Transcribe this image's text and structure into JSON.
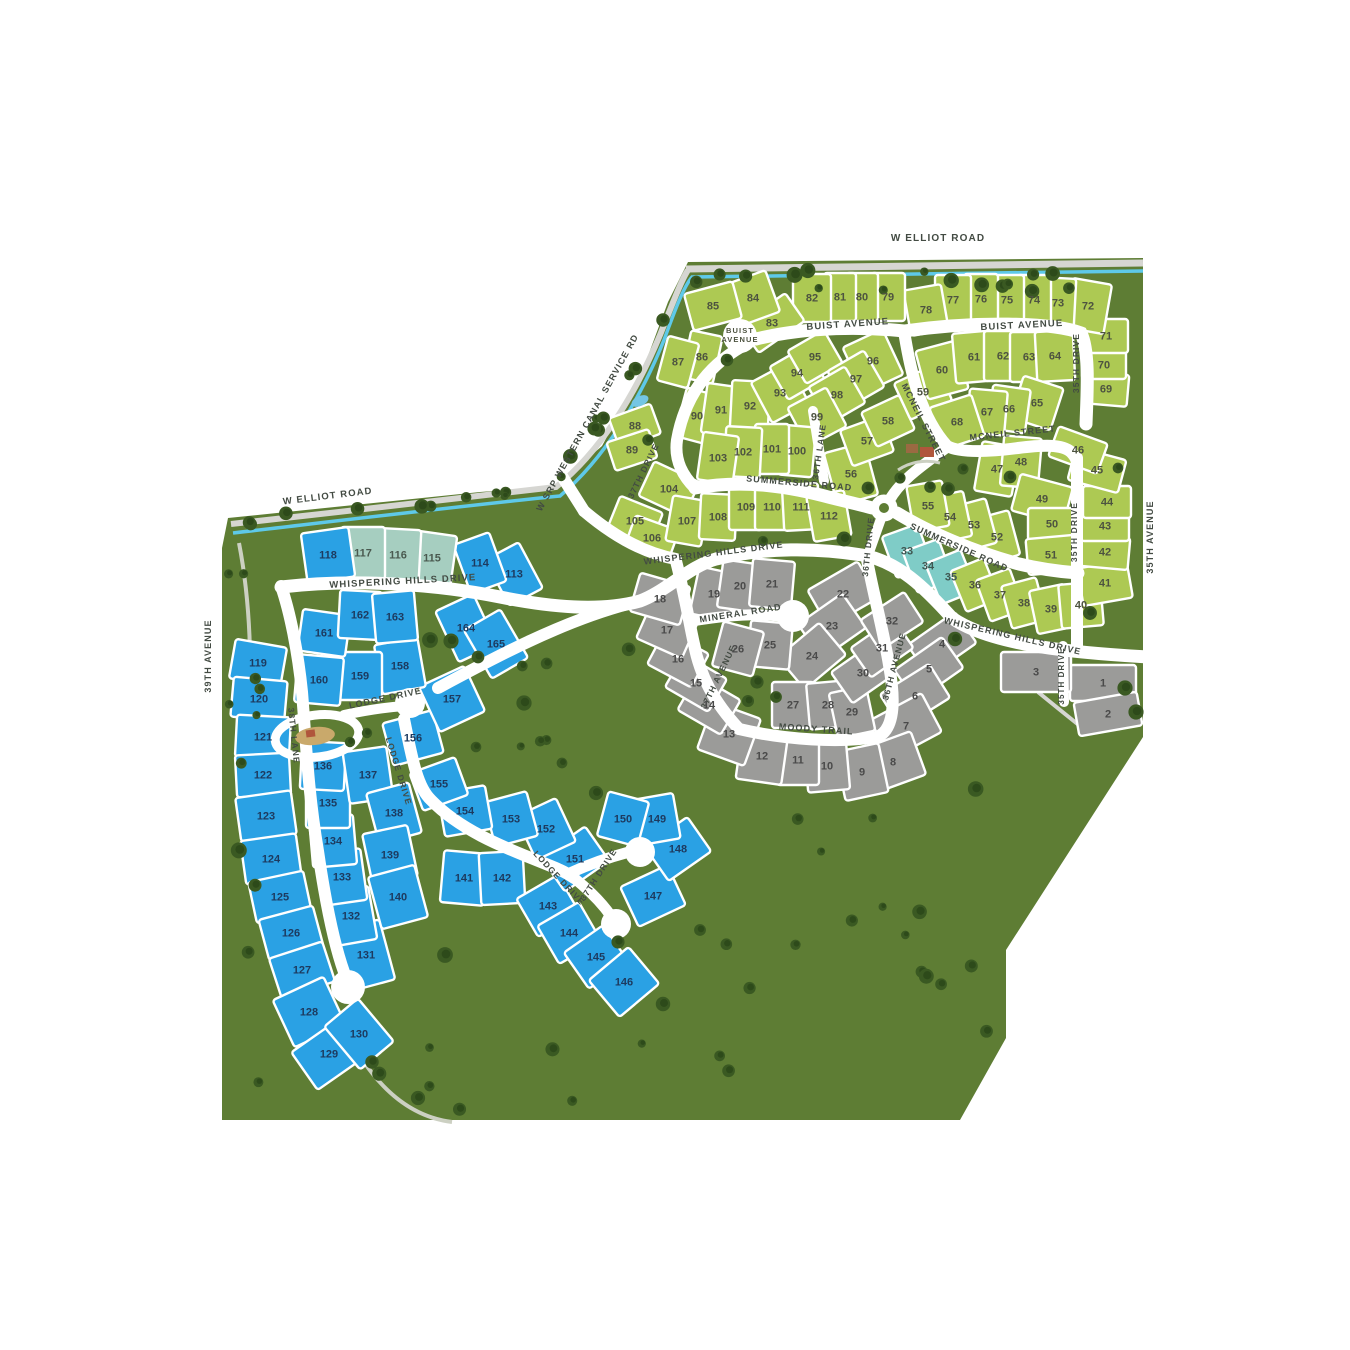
{
  "map_name": "community-site-plan",
  "colors": {
    "land": "#5e7d34",
    "tree_dark": "#2d4a1a",
    "tree_mid": "#3a5922",
    "road": "#ffffff",
    "service_road": "#d6d6d2",
    "canal": "#5ec9e9",
    "trail": "#ccd0c2",
    "lot_green": "#adc953",
    "lot_blue": "#2aa1e4",
    "lot_gray": "#9b9b99",
    "lot_teal": "#7fccc7",
    "lot_seafoam": "#a6cec0",
    "num_green": "#4d5340",
    "num_gray": "#4a4a4a",
    "num_blue": "#1d3a5f",
    "num_teal": "#3f5752",
    "num_seafoam": "#4a5a50",
    "label_text": "#434b43",
    "bulb_text": "#4d5340",
    "amenity_roof": "#b0563c",
    "amenity_wall": "#9a6a42",
    "playground": "#c9a96b",
    "water": "#74c6e3"
  },
  "cul_de_sac_label": [
    "BUIST",
    "AVENUE"
  ],
  "street_labels": [
    {
      "t": "W ELLIOT ROAD",
      "x": 938,
      "y": 241,
      "r": 0,
      "s": 10
    },
    {
      "t": "W ELLIOT ROAD",
      "x": 328,
      "y": 499,
      "r": -7,
      "s": 9.5
    },
    {
      "t": "W SRP WESTERN CANAL SERVICE RD",
      "x": 590,
      "y": 424,
      "r": -61,
      "s": 9
    },
    {
      "t": "BUIST AVENUE",
      "x": 848,
      "y": 327,
      "r": -4,
      "s": 9.5
    },
    {
      "t": "BUIST AVENUE",
      "x": 1022,
      "y": 328,
      "r": -3,
      "s": 9.5
    },
    {
      "t": "MCNEIL STREET",
      "x": 921,
      "y": 424,
      "r": 63,
      "s": 9
    },
    {
      "t": "MCNEIL STREET",
      "x": 1013,
      "y": 436,
      "r": -6,
      "s": 9
    },
    {
      "t": "35TH DRIVE",
      "x": 1079,
      "y": 363,
      "r": -90,
      "s": 8.5
    },
    {
      "t": "37TH DRIVE",
      "x": 646,
      "y": 472,
      "r": -64,
      "s": 8.5
    },
    {
      "t": "36TH LANE",
      "x": 822,
      "y": 452,
      "r": -82,
      "s": 8.5
    },
    {
      "t": "SUMMERSIDE ROAD",
      "x": 799,
      "y": 486,
      "r": 5,
      "s": 9
    },
    {
      "t": "SUMMERSIDE ROAD",
      "x": 958,
      "y": 550,
      "r": 24,
      "s": 9
    },
    {
      "t": "35TH DRIVE",
      "x": 1077,
      "y": 532,
      "r": -90,
      "s": 8.5
    },
    {
      "t": "35TH AVENUE",
      "x": 1153,
      "y": 537,
      "r": -90,
      "s": 9
    },
    {
      "t": "WHISPERING HILLS DRIVE",
      "x": 403,
      "y": 584,
      "r": -3,
      "s": 9.5
    },
    {
      "t": "WHISPERING HILLS DRIVE",
      "x": 714,
      "y": 556,
      "r": -7,
      "s": 9
    },
    {
      "t": "WHISPERING HILLS DRIVE",
      "x": 1012,
      "y": 639,
      "r": 13,
      "s": 9
    },
    {
      "t": "36TH DRIVE",
      "x": 871,
      "y": 547,
      "r": -84,
      "s": 8.5
    },
    {
      "t": "MINERAL ROAD",
      "x": 741,
      "y": 616,
      "r": -9,
      "s": 9
    },
    {
      "t": "37TH AVENUE",
      "x": 721,
      "y": 678,
      "r": -64,
      "s": 8.5
    },
    {
      "t": "36TH AVENUE",
      "x": 897,
      "y": 667,
      "r": -75,
      "s": 8.5
    },
    {
      "t": "MOODY TRAIL",
      "x": 816,
      "y": 732,
      "r": 4,
      "s": 9
    },
    {
      "t": "35TH DRIVE",
      "x": 1064,
      "y": 676,
      "r": -90,
      "s": 8
    },
    {
      "t": "LODGE DRIVE",
      "x": 386,
      "y": 701,
      "r": -12,
      "s": 9
    },
    {
      "t": "LODGE DRIVE",
      "x": 396,
      "y": 772,
      "r": 73,
      "s": 8.5
    },
    {
      "t": "LODGE DRIVE",
      "x": 557,
      "y": 880,
      "r": 47,
      "s": 8.5
    },
    {
      "t": "37TH DRIVE",
      "x": 601,
      "y": 876,
      "r": -57,
      "s": 8.5
    },
    {
      "t": "38TH LANE",
      "x": 291,
      "y": 736,
      "r": 84,
      "s": 8.5
    },
    {
      "t": "39TH AVENUE",
      "x": 211,
      "y": 656,
      "r": -90,
      "s": 9
    }
  ],
  "lots_format": [
    "number",
    "color_key",
    "cx",
    "cy",
    "width",
    "height",
    "rotation_deg"
  ],
  "lots": [
    [
      1,
      "g",
      1103,
      683,
      66,
      36,
      0
    ],
    [
      2,
      "g",
      1108,
      714,
      64,
      34,
      -10
    ],
    [
      3,
      "g",
      1036,
      672,
      70,
      40,
      0
    ],
    [
      4,
      "g",
      942,
      644,
      58,
      38,
      -35
    ],
    [
      5,
      "g",
      929,
      669,
      58,
      38,
      -35
    ],
    [
      6,
      "g",
      915,
      696,
      58,
      40,
      -32
    ],
    [
      7,
      "g",
      906,
      726,
      58,
      44,
      -28
    ],
    [
      8,
      "g",
      893,
      762,
      54,
      46,
      -20
    ],
    [
      9,
      "g",
      862,
      772,
      44,
      50,
      -12
    ],
    [
      10,
      "g",
      827,
      766,
      42,
      50,
      -5
    ],
    [
      11,
      "g",
      798,
      760,
      42,
      50,
      0
    ],
    [
      12,
      "g",
      762,
      756,
      46,
      52,
      8
    ],
    [
      13,
      "g",
      729,
      734,
      50,
      50,
      20
    ],
    [
      14,
      "g",
      709,
      705,
      50,
      40,
      30
    ],
    [
      15,
      "g",
      696,
      683,
      50,
      38,
      30
    ],
    [
      16,
      "g",
      678,
      659,
      50,
      38,
      28
    ],
    [
      17,
      "g",
      667,
      630,
      50,
      40,
      24
    ],
    [
      18,
      "g",
      660,
      599,
      52,
      40,
      16
    ],
    [
      19,
      "g",
      714,
      594,
      40,
      48,
      12
    ],
    [
      20,
      "g",
      740,
      586,
      40,
      48,
      8
    ],
    [
      21,
      "g",
      772,
      584,
      42,
      48,
      5
    ],
    [
      22,
      "g",
      843,
      594,
      58,
      42,
      -30
    ],
    [
      23,
      "g",
      832,
      626,
      54,
      42,
      -35
    ],
    [
      24,
      "g",
      812,
      656,
      54,
      42,
      -40
    ],
    [
      25,
      "g",
      770,
      645,
      42,
      46,
      5
    ],
    [
      26,
      "g",
      738,
      649,
      42,
      46,
      15
    ],
    [
      27,
      "g",
      793,
      705,
      42,
      46,
      0
    ],
    [
      28,
      "g",
      828,
      705,
      40,
      46,
      -5
    ],
    [
      29,
      "g",
      852,
      712,
      38,
      46,
      -12
    ],
    [
      30,
      "g",
      863,
      673,
      52,
      38,
      -35
    ],
    [
      31,
      "g",
      882,
      648,
      52,
      36,
      -35
    ],
    [
      32,
      "g",
      892,
      621,
      52,
      36,
      -33
    ],
    [
      33,
      "t",
      907,
      551,
      38,
      44,
      -20
    ],
    [
      34,
      "t",
      928,
      566,
      38,
      44,
      -20
    ],
    [
      35,
      "t",
      951,
      577,
      38,
      44,
      -22
    ],
    [
      36,
      "n",
      975,
      585,
      36,
      44,
      -22
    ],
    [
      37,
      "n",
      1000,
      595,
      36,
      44,
      -20
    ],
    [
      38,
      "n",
      1024,
      603,
      36,
      44,
      -15
    ],
    [
      39,
      "n",
      1051,
      609,
      36,
      44,
      -12
    ],
    [
      40,
      "n",
      1081,
      605,
      42,
      44,
      -5
    ],
    [
      41,
      "n",
      1105,
      583,
      50,
      38,
      -10
    ],
    [
      42,
      "n",
      1105,
      552,
      48,
      32,
      5
    ],
    [
      43,
      "n",
      1105,
      526,
      48,
      30,
      0
    ],
    [
      44,
      "n",
      1107,
      502,
      48,
      32,
      0
    ],
    [
      45,
      "n",
      1097,
      470,
      52,
      34,
      15
    ],
    [
      46,
      "n",
      1078,
      450,
      52,
      32,
      20
    ],
    [
      47,
      "n",
      997,
      469,
      38,
      50,
      10
    ],
    [
      48,
      "n",
      1021,
      462,
      38,
      50,
      5
    ],
    [
      49,
      "n",
      1042,
      499,
      54,
      38,
      15
    ],
    [
      50,
      "n",
      1052,
      524,
      48,
      32,
      0
    ],
    [
      51,
      "n",
      1051,
      555,
      48,
      36,
      -5
    ],
    [
      52,
      "n",
      997,
      537,
      36,
      46,
      -15
    ],
    [
      53,
      "n",
      974,
      525,
      36,
      46,
      -15
    ],
    [
      54,
      "n",
      950,
      517,
      36,
      46,
      -12
    ],
    [
      55,
      "n",
      928,
      506,
      36,
      46,
      -10
    ],
    [
      56,
      "n",
      851,
      474,
      42,
      54,
      -15
    ],
    [
      57,
      "n",
      867,
      441,
      44,
      38,
      -20
    ],
    [
      58,
      "n",
      888,
      421,
      42,
      38,
      -25
    ],
    [
      59,
      "n",
      923,
      392,
      46,
      40,
      -25
    ],
    [
      60,
      "n",
      942,
      370,
      42,
      50,
      -15
    ],
    [
      61,
      "n",
      974,
      357,
      40,
      50,
      -5
    ],
    [
      62,
      "n",
      1003,
      356,
      38,
      50,
      0
    ],
    [
      63,
      "n",
      1029,
      357,
      38,
      50,
      0
    ],
    [
      64,
      "n",
      1055,
      356,
      38,
      50,
      -3
    ],
    [
      65,
      "n",
      1037,
      403,
      42,
      44,
      18
    ],
    [
      66,
      "n",
      1009,
      409,
      38,
      44,
      8
    ],
    [
      67,
      "n",
      987,
      412,
      38,
      44,
      5
    ],
    [
      68,
      "n",
      957,
      422,
      44,
      44,
      -18
    ],
    [
      69,
      "n",
      1106,
      389,
      44,
      32,
      5
    ],
    [
      70,
      "n",
      1104,
      365,
      44,
      28,
      0
    ],
    [
      71,
      "n",
      1106,
      336,
      44,
      34,
      0
    ],
    [
      72,
      "n",
      1088,
      306,
      40,
      50,
      10
    ],
    [
      73,
      "n",
      1058,
      303,
      34,
      50,
      3
    ],
    [
      74,
      "n",
      1034,
      300,
      34,
      50,
      0
    ],
    [
      75,
      "n",
      1007,
      300,
      34,
      50,
      0
    ],
    [
      76,
      "n",
      981,
      299,
      34,
      50,
      0
    ],
    [
      77,
      "n",
      953,
      300,
      36,
      50,
      0
    ],
    [
      78,
      "n",
      926,
      310,
      38,
      46,
      -10
    ],
    [
      79,
      "n",
      888,
      297,
      34,
      48,
      0
    ],
    [
      80,
      "n",
      862,
      297,
      32,
      48,
      0
    ],
    [
      81,
      "n",
      840,
      297,
      32,
      48,
      0
    ],
    [
      82,
      "n",
      812,
      298,
      38,
      48,
      0
    ],
    [
      83,
      "n",
      772,
      323,
      56,
      34,
      -35
    ],
    [
      84,
      "n",
      753,
      298,
      42,
      44,
      -20
    ],
    [
      85,
      "n",
      713,
      306,
      50,
      38,
      -15
    ],
    [
      86,
      "n",
      702,
      357,
      32,
      48,
      12
    ],
    [
      87,
      "n",
      678,
      362,
      32,
      46,
      15
    ],
    [
      88,
      "n",
      635,
      426,
      44,
      32,
      -20
    ],
    [
      89,
      "n",
      632,
      450,
      44,
      30,
      -18
    ],
    [
      90,
      "n",
      697,
      416,
      34,
      50,
      15
    ],
    [
      91,
      "n",
      721,
      410,
      34,
      50,
      8
    ],
    [
      92,
      "n",
      750,
      406,
      38,
      50,
      3
    ],
    [
      93,
      "n",
      780,
      393,
      42,
      46,
      -28
    ],
    [
      94,
      "n",
      797,
      373,
      42,
      38,
      -30
    ],
    [
      95,
      "n",
      815,
      357,
      42,
      38,
      -30
    ],
    [
      96,
      "n",
      873,
      361,
      44,
      50,
      -25
    ],
    [
      97,
      "n",
      856,
      379,
      42,
      42,
      -30
    ],
    [
      98,
      "n",
      837,
      395,
      42,
      42,
      -30
    ],
    [
      99,
      "n",
      817,
      417,
      44,
      44,
      -28
    ],
    [
      100,
      "n",
      797,
      451,
      34,
      50,
      5
    ],
    [
      101,
      "n",
      772,
      449,
      34,
      50,
      0
    ],
    [
      102,
      "n",
      743,
      452,
      36,
      50,
      3
    ],
    [
      103,
      "n",
      718,
      458,
      36,
      48,
      8
    ],
    [
      104,
      "n",
      669,
      489,
      50,
      38,
      25
    ],
    [
      105,
      "n",
      635,
      521,
      46,
      36,
      22
    ],
    [
      106,
      "n",
      652,
      538,
      46,
      32,
      20
    ],
    [
      107,
      "n",
      687,
      521,
      36,
      46,
      10
    ],
    [
      108,
      "n",
      718,
      517,
      36,
      46,
      3
    ],
    [
      109,
      "n",
      746,
      507,
      34,
      46,
      0
    ],
    [
      110,
      "n",
      772,
      507,
      34,
      46,
      0
    ],
    [
      111,
      "n",
      801,
      507,
      36,
      46,
      -3
    ],
    [
      112,
      "n",
      829,
      516,
      38,
      46,
      -10
    ],
    [
      113,
      "b",
      514,
      574,
      38,
      52,
      -28
    ],
    [
      114,
      "b",
      480,
      563,
      38,
      52,
      -20
    ],
    [
      115,
      "s",
      432,
      558,
      44,
      50,
      8
    ],
    [
      116,
      "s",
      398,
      555,
      44,
      52,
      3
    ],
    [
      117,
      "s",
      363,
      553,
      44,
      52,
      0
    ],
    [
      118,
      "b",
      328,
      555,
      48,
      50,
      -8
    ],
    [
      119,
      "b",
      258,
      663,
      52,
      40,
      10
    ],
    [
      120,
      "b",
      259,
      699,
      54,
      40,
      5
    ],
    [
      121,
      "b",
      263,
      737,
      54,
      42,
      3
    ],
    [
      122,
      "b",
      263,
      775,
      54,
      42,
      -3
    ],
    [
      123,
      "b",
      266,
      816,
      56,
      44,
      -8
    ],
    [
      124,
      "b",
      271,
      859,
      56,
      44,
      -8
    ],
    [
      125,
      "b",
      280,
      897,
      56,
      42,
      -12
    ],
    [
      126,
      "b",
      291,
      933,
      56,
      42,
      -15
    ],
    [
      127,
      "b",
      302,
      970,
      56,
      42,
      -18
    ],
    [
      128,
      "b",
      309,
      1012,
      56,
      52,
      -25
    ],
    [
      129,
      "b",
      329,
      1054,
      60,
      46,
      -35
    ],
    [
      130,
      "b",
      359,
      1034,
      44,
      56,
      -40
    ],
    [
      131,
      "b",
      366,
      955,
      44,
      62,
      -15
    ],
    [
      132,
      "b",
      351,
      916,
      44,
      54,
      -10
    ],
    [
      133,
      "b",
      342,
      877,
      44,
      52,
      -8
    ],
    [
      134,
      "b",
      333,
      841,
      44,
      50,
      -5
    ],
    [
      135,
      "b",
      328,
      803,
      44,
      50,
      0
    ],
    [
      136,
      "b",
      323,
      766,
      44,
      48,
      3
    ],
    [
      137,
      "b",
      368,
      775,
      44,
      52,
      -8
    ],
    [
      138,
      "b",
      394,
      813,
      44,
      52,
      -15
    ],
    [
      139,
      "b",
      390,
      855,
      46,
      52,
      -12
    ],
    [
      140,
      "b",
      398,
      897,
      48,
      54,
      -15
    ],
    [
      141,
      "b",
      464,
      878,
      44,
      52,
      5
    ],
    [
      142,
      "b",
      502,
      878,
      44,
      52,
      -3
    ],
    [
      143,
      "b",
      548,
      906,
      48,
      44,
      -30
    ],
    [
      144,
      "b",
      569,
      933,
      48,
      44,
      -30
    ],
    [
      145,
      "b",
      596,
      957,
      48,
      44,
      -35
    ],
    [
      146,
      "b",
      624,
      982,
      52,
      48,
      -40
    ],
    [
      147,
      "b",
      653,
      896,
      52,
      44,
      -25
    ],
    [
      148,
      "b",
      678,
      849,
      52,
      42,
      -35
    ],
    [
      149,
      "b",
      657,
      819,
      40,
      46,
      -10
    ],
    [
      150,
      "b",
      623,
      819,
      42,
      46,
      15
    ],
    [
      151,
      "b",
      575,
      859,
      54,
      42,
      -35
    ],
    [
      152,
      "b",
      546,
      829,
      44,
      48,
      -25
    ],
    [
      153,
      "b",
      511,
      819,
      44,
      46,
      -15
    ],
    [
      154,
      "b",
      465,
      811,
      48,
      44,
      -10
    ],
    [
      155,
      "b",
      439,
      784,
      48,
      40,
      -20
    ],
    [
      156,
      "b",
      413,
      738,
      52,
      44,
      -15
    ],
    [
      157,
      "b",
      452,
      699,
      50,
      50,
      -25
    ],
    [
      158,
      "b",
      400,
      666,
      44,
      50,
      -10
    ],
    [
      159,
      "b",
      360,
      676,
      44,
      48,
      0
    ],
    [
      160,
      "b",
      319,
      680,
      46,
      48,
      5
    ],
    [
      161,
      "b",
      324,
      633,
      48,
      42,
      8
    ],
    [
      162,
      "b",
      360,
      615,
      42,
      48,
      3
    ],
    [
      163,
      "b",
      395,
      617,
      42,
      50,
      -5
    ],
    [
      164,
      "b",
      466,
      628,
      42,
      56,
      -25
    ],
    [
      165,
      "b",
      496,
      644,
      42,
      56,
      -30
    ]
  ]
}
